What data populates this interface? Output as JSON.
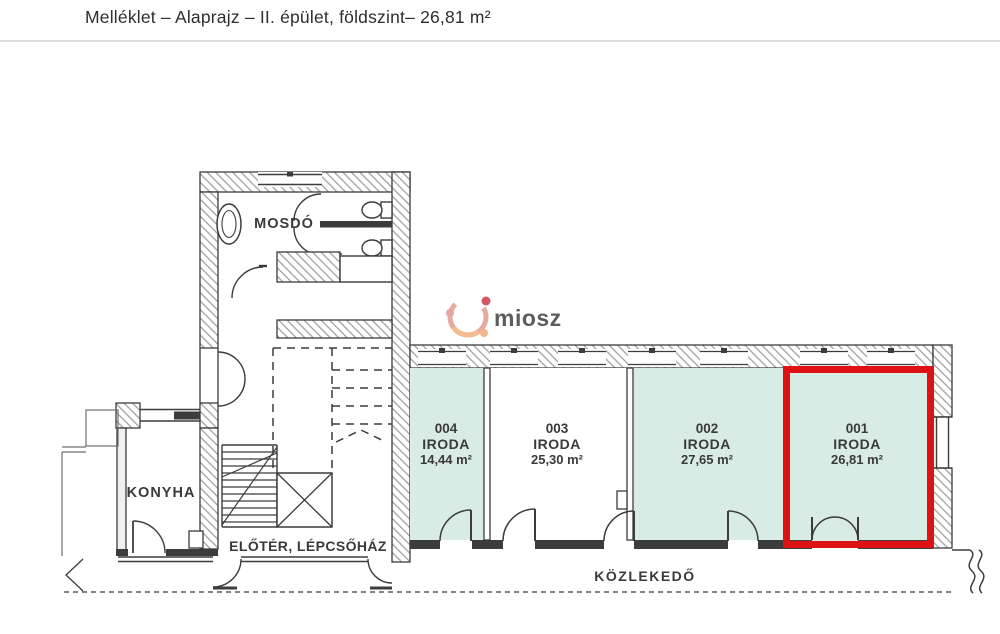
{
  "header": {
    "title": "Melléklet – Alaprajz – II. épület, földszint– 26,81 m²"
  },
  "watermark": {
    "text": "miosz"
  },
  "plan": {
    "labels": {
      "washroom": "MOSDÓ",
      "kitchen": "KONYHA",
      "foyer": "ELŐTÉR, LÉPCSŐHÁZ",
      "corridor": "KÖZLEKEDŐ"
    },
    "offices": [
      {
        "number": "004",
        "type": "IRODA",
        "area": "14,44 m²",
        "fill": "#d9ebe5",
        "highlighted": false
      },
      {
        "number": "003",
        "type": "IRODA",
        "area": "25,30 m²",
        "fill": "#ffffff",
        "highlighted": false
      },
      {
        "number": "002",
        "type": "IRODA",
        "area": "27,65 m²",
        "fill": "#d9ebe5",
        "highlighted": false
      },
      {
        "number": "001",
        "type": "IRODA",
        "area": "26,81 m²",
        "fill": "#d9ebe5",
        "highlighted": true
      }
    ],
    "colors": {
      "highlight": "#de1212",
      "wall": "#3c3c3c",
      "hatch": "#9c9c9c",
      "room_fill": "#d9ebe5"
    }
  }
}
